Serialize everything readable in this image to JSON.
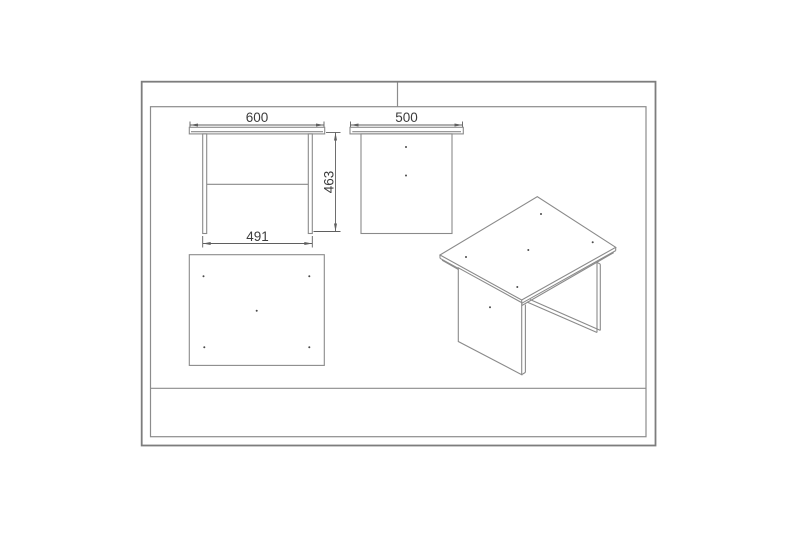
{
  "document": {
    "type": "technical-drawing",
    "subject": "table-assembly-orthographic-and-isometric-views",
    "background": "#ffffff"
  },
  "views": {
    "front": {
      "name": "front-elevation",
      "dim_width_top": "600",
      "dim_width_bottom": "491",
      "dim_height": "463"
    },
    "side": {
      "name": "side-elevation",
      "dim_depth": "500",
      "screw_dots": 2
    },
    "plan": {
      "name": "top-plan-view",
      "screw_dots": 5
    },
    "iso": {
      "name": "isometric-view",
      "screw_dots_top": 5,
      "screw_dots_panel": 1
    }
  },
  "colors": {
    "frame_line": "#7d7d7d",
    "drawing_line": "#8a8a8a",
    "dimension_line": "#5f5f5f",
    "text": "#3c3c3c"
  }
}
